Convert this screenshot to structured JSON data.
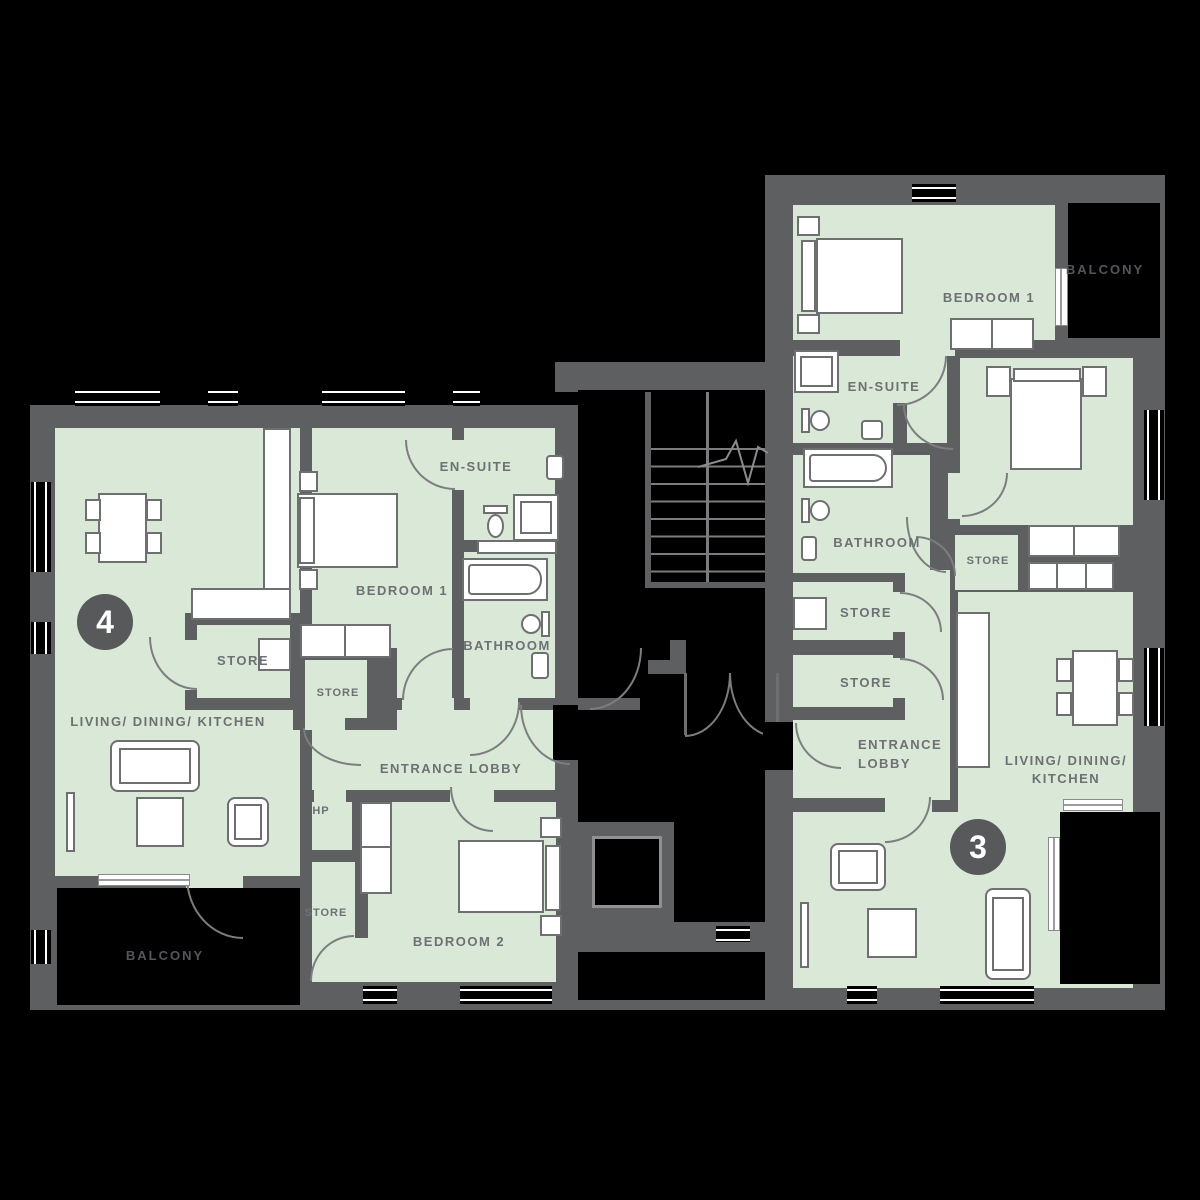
{
  "units": {
    "u4": {
      "number": "4",
      "living": "LIVING/ DINING/ KITCHEN",
      "bedroom1": "BEDROOM 1",
      "bedroom2": "BEDROOM 2",
      "ensuite": "EN-SUITE",
      "bathroom": "BATHROOM",
      "store1": "STORE",
      "store2": "STORE",
      "store3": "STORE",
      "hp": "HP",
      "lobby": "ENTRANCE LOBBY",
      "balcony": "BALCONY"
    },
    "u3": {
      "number": "3",
      "bedroom1": "BEDROOM 1",
      "bedroom2": "BEDROOM 2",
      "ensuite": "EN-SUITE",
      "bathroom": "BATHROOM",
      "store_a": "STORE",
      "store_b": "STORE",
      "store_c": "STORE",
      "lobby_line1": "ENTRANCE",
      "lobby_line2": "LOBBY",
      "living_line1": "LIVING/ DINING/",
      "living_line2": "KITCHEN",
      "balcony": "BALCONY"
    }
  },
  "colors": {
    "background": "#000000",
    "wall": "#5e5f60",
    "floor": "#d9e8d7",
    "furniture_outline": "#6e6f70",
    "label": "#6e7074",
    "balcony_label": "#54565a",
    "badge_fill": "#58595b",
    "badge_text": "#ffffff",
    "door_arc": "#7c7d7f"
  }
}
